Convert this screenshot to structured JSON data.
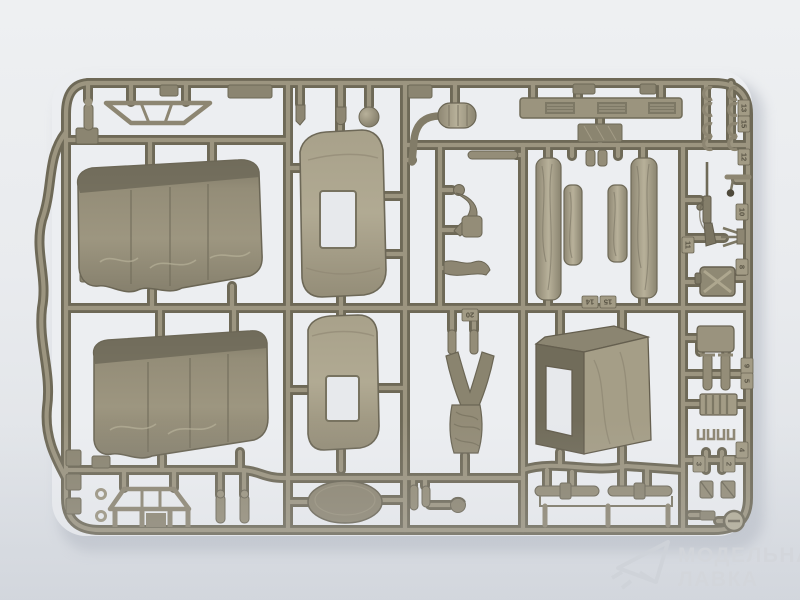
{
  "scene": {
    "type": "photograph",
    "subject": "olive-drab injection-molded model kit sprue on a light studio background",
    "background_top": "#eef0f2",
    "background_bottom": "#d8dce2",
    "plastic_color": "#8e8874",
    "plastic_dark": "#6f6a58",
    "plastic_light": "#aca590",
    "shadow_color": "#b2b7c1"
  },
  "watermark": {
    "line1": "МОДЕЛЬНАЯ",
    "line2": "ЛАВКА",
    "logo": "paper-plane-icon",
    "color": "#d3d6db"
  },
  "tags": [
    {
      "label": "13"
    },
    {
      "label": "15"
    },
    {
      "label": "12"
    },
    {
      "label": "10"
    },
    {
      "label": "11"
    },
    {
      "label": "8"
    },
    {
      "label": "9"
    },
    {
      "label": "5"
    },
    {
      "label": "4"
    },
    {
      "label": "3"
    },
    {
      "label": "2"
    },
    {
      "label": "14"
    },
    {
      "label": "15"
    },
    {
      "label": "20"
    }
  ],
  "parts": [
    "cargo-bed-tarpaulin-1",
    "cargo-bed-tarpaulin-2",
    "cab-canvas-top-1",
    "cab-canvas-top-2",
    "cab-canvas-rear-panel",
    "rolled-tarpaulin-long-1",
    "rolled-tarpaulin-short-1",
    "rolled-tarpaulin-short-2",
    "rolled-tarpaulin-long-2",
    "running-board-with-treads",
    "exhaust-muffler-with-pipe",
    "headlight-sphere",
    "roof-frame-bracket",
    "windshield-frame",
    "seat-cushion-oval",
    "driver-figure-legs-torso",
    "driver-figure-arm",
    "driver-figure-head",
    "rifle",
    "jerry-can",
    "rear-view-mirror",
    "crank-fork",
    "seat-backrest",
    "radiator-grille",
    "pedal-pair",
    "axle-rods",
    "hose-clamps",
    "sprue-gate-letter-tab"
  ]
}
